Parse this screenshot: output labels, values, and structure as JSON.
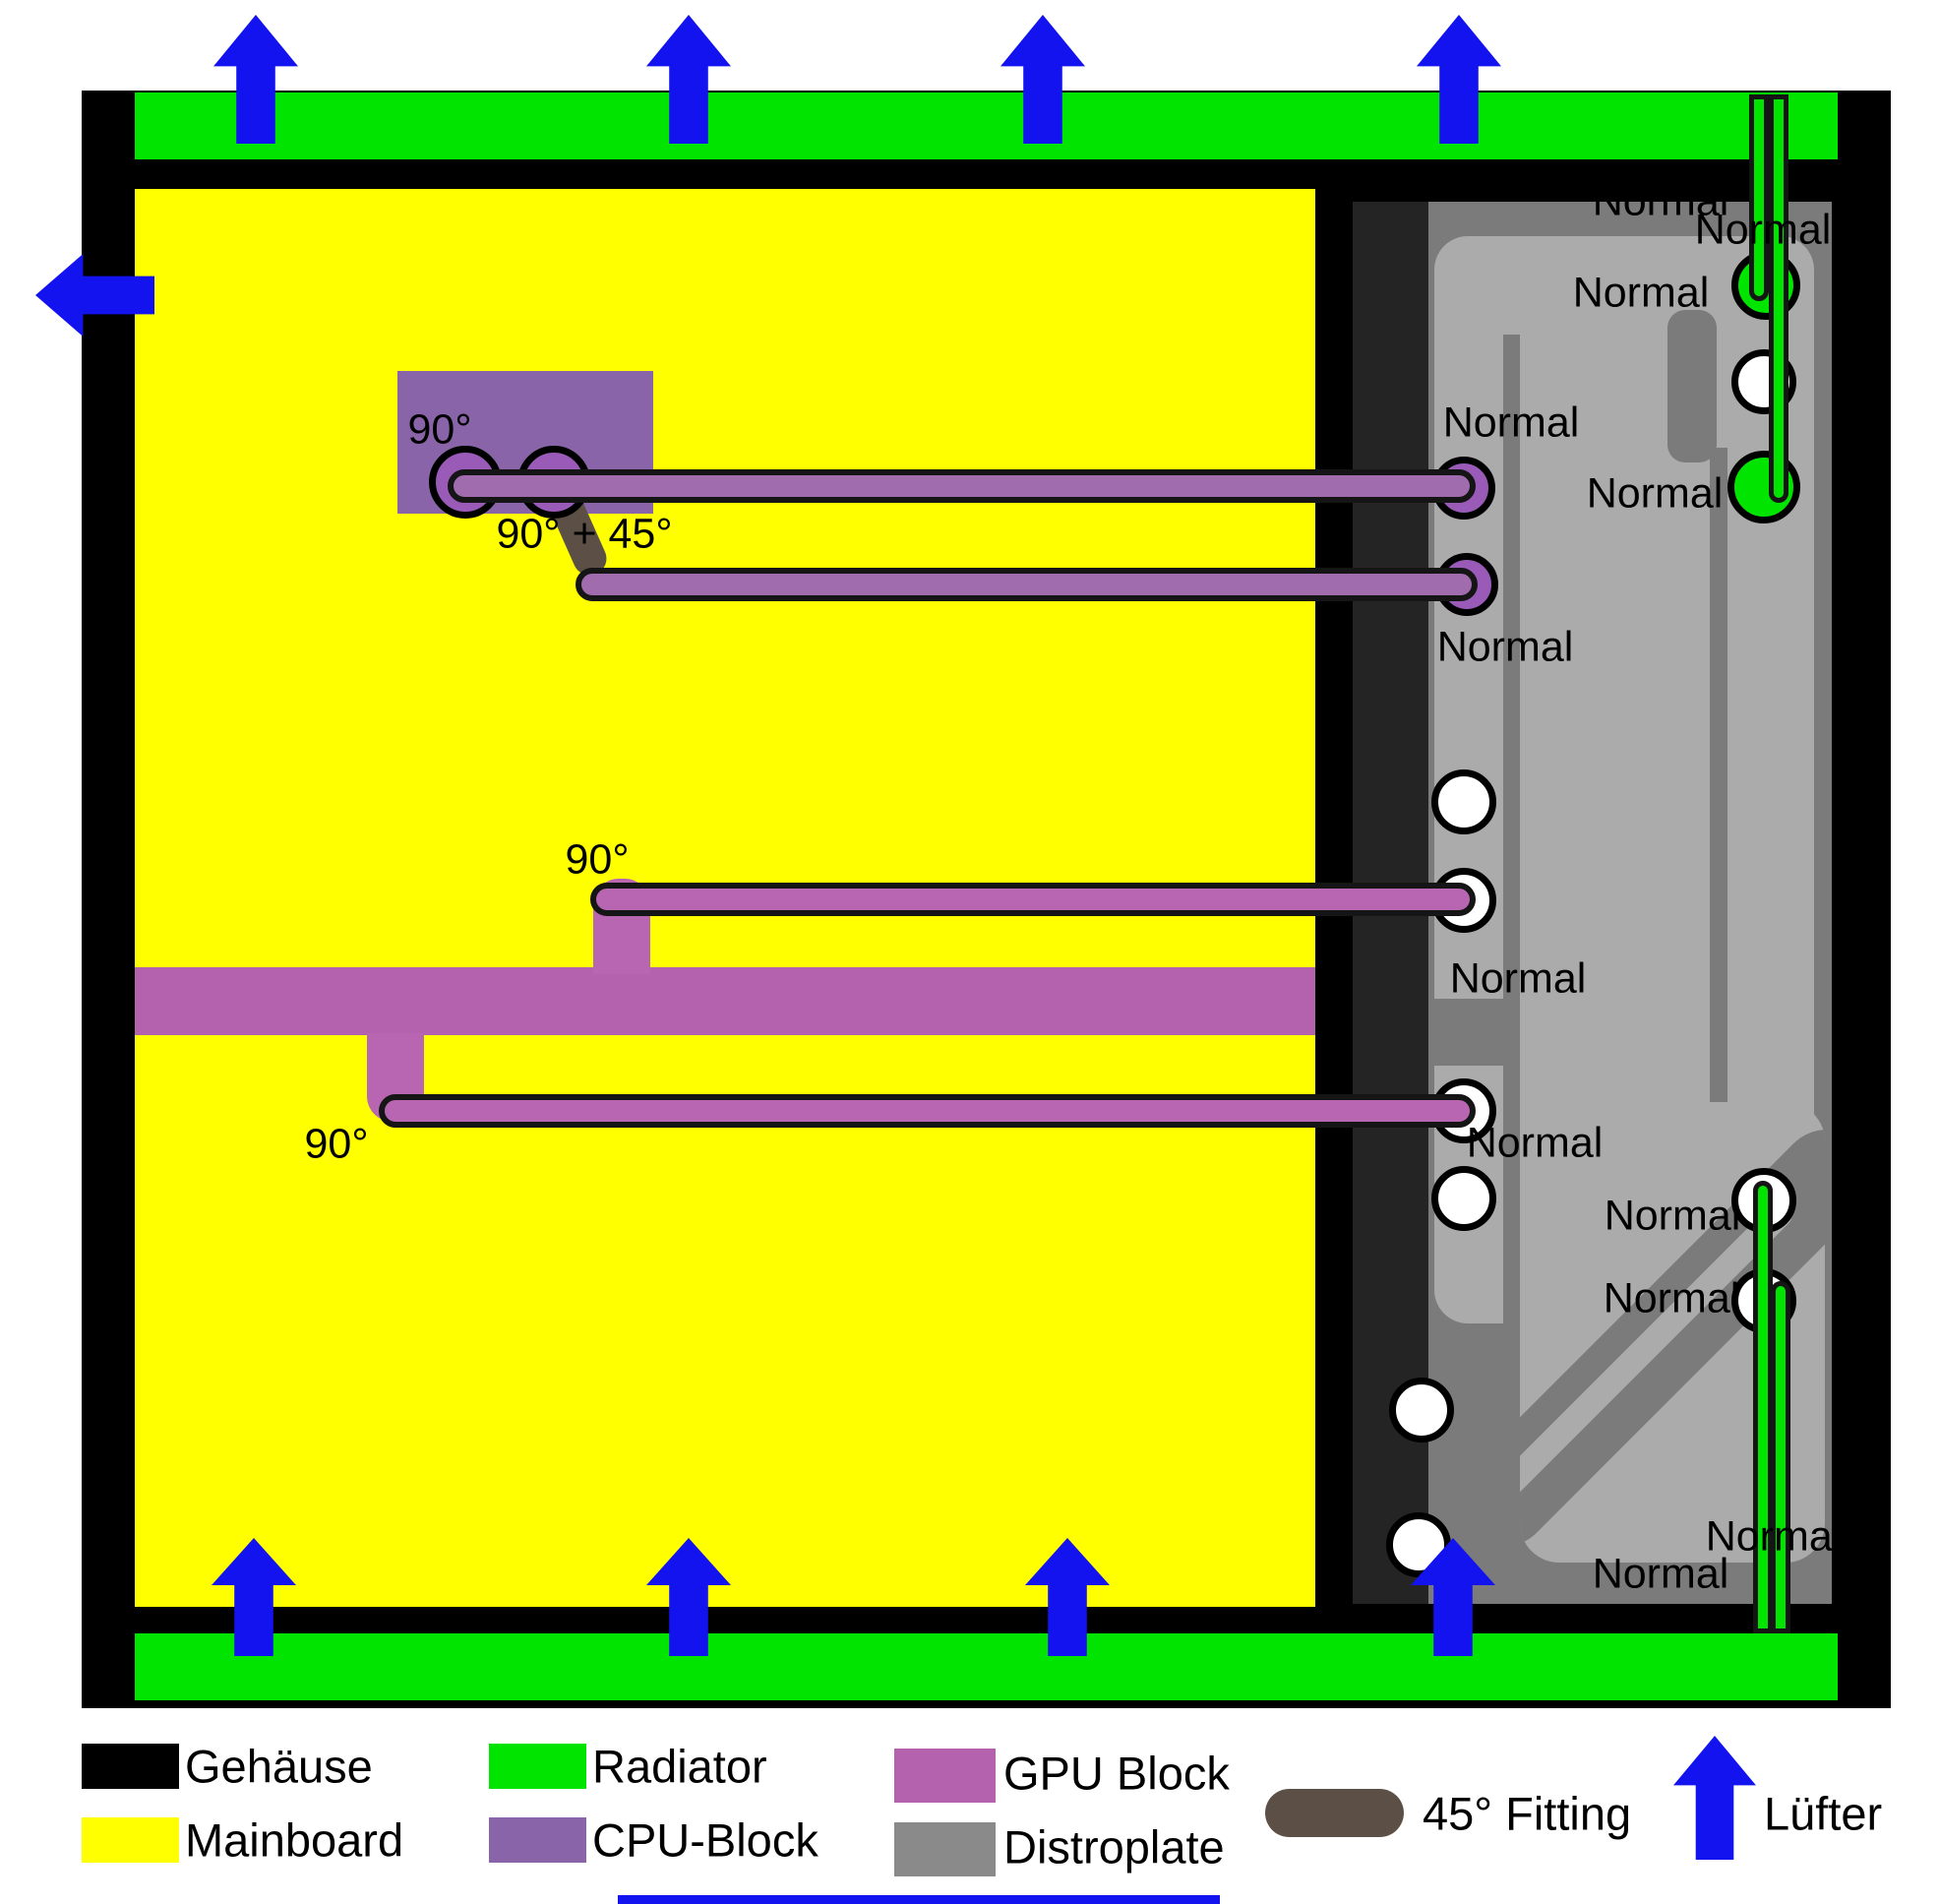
{
  "title": "Watercooling loop layout diagram",
  "diagram": {
    "normal_label": "Normal",
    "angle_labels": {
      "deg90": "90°",
      "deg90_45": "90° + 45°"
    }
  },
  "legend": {
    "items": [
      {
        "id": "gehaeuse",
        "label": "Gehäuse",
        "color": "#000000"
      },
      {
        "id": "mainboard",
        "label": "Mainboard",
        "color": "#ffff00"
      },
      {
        "id": "radiator",
        "label": "Radiator",
        "color": "#00e400"
      },
      {
        "id": "cpu_block",
        "label": "CPU-Block",
        "color": "#8a64a8"
      },
      {
        "id": "gpu_block",
        "label": "GPU Block",
        "color": "#b562ae"
      },
      {
        "id": "distroplate",
        "label": "Distroplate",
        "color": "#8a8a8a"
      },
      {
        "id": "fitting_45",
        "label": "45° Fitting",
        "color": "#5c5046"
      },
      {
        "id": "luefter",
        "label": "Lüfter",
        "color": "#1313ef"
      }
    ]
  },
  "colors": {
    "case": "#000000",
    "mainboard": "#ffff00",
    "radiator": "#00e400",
    "cpu_block": "#8a64a8",
    "gpu_block": "#b562ae",
    "tube_cpu": "#a06cae",
    "tube_gpu": "#b866b2",
    "fitting_purple": "#9a5ab8",
    "fitting_45": "#5c5046",
    "distro_light": "#ababab",
    "distro_dark": "#7b7b7b",
    "distro_strip": "#242424",
    "distro_legend": "#8a8a8a",
    "fan": "#1313ef",
    "port_white": "#ffffff"
  }
}
